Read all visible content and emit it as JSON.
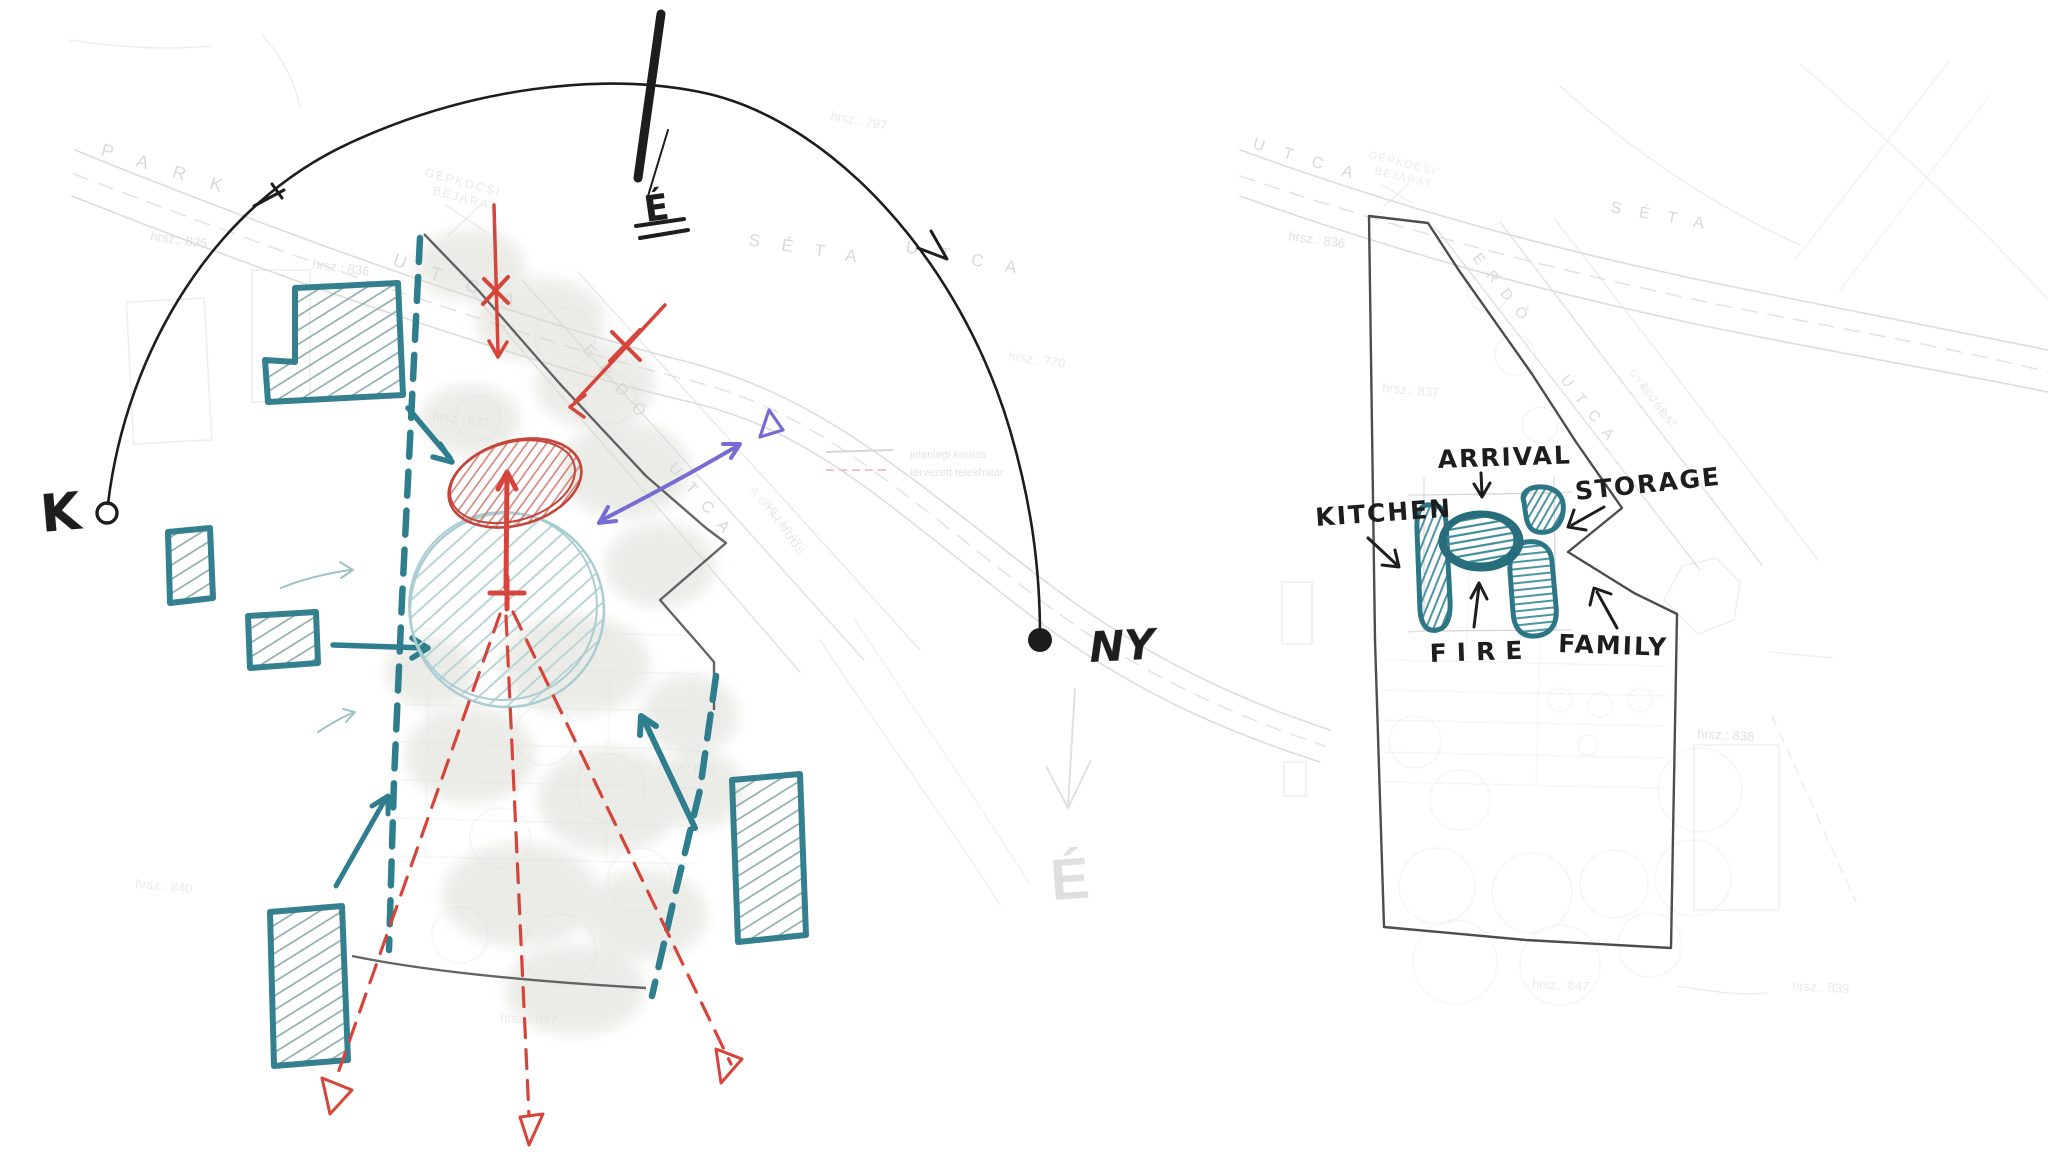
{
  "colors": {
    "ink": "#1d1d1d",
    "teal": "#2f7e8d",
    "teal_light": "#9dc3c7",
    "red": "#d6453c",
    "purple": "#776bd4",
    "map_gray": "#d7d7d5"
  },
  "left_sketch": {
    "compass": {
      "east": "K",
      "west": "NY",
      "north": "É",
      "map_north": "É"
    },
    "streets": {
      "park": "PARK",
      "park_utca": "UTCA",
      "seta": "SÉTA",
      "seta_utca": "UTCA",
      "erdo": "ERDŐ",
      "erdo_utca": "UTCA"
    },
    "entrances": {
      "gepkocsi_line1": "GÉPKOCSI",
      "gepkocsi_line2": "BEJÁRAT",
      "gyalogos_line1": "A GYALOGOS",
      "gyalogos_line2": "BEJÁRAT"
    },
    "parcels": {
      "p835": "hrsz.: 835",
      "p836": "hrsz.: 836",
      "p837": "hrsz.: 837",
      "p797": "hrsz.: 797",
      "p770": "hrsz.: 770",
      "p840": "hrsz.: 840",
      "p838": "hrsz.: 838",
      "p847": "hrsz.: 847"
    },
    "legend": {
      "item1": "jelenlegi kerítés",
      "item2": "tervezett telekhatár"
    }
  },
  "right_sketch": {
    "labels": {
      "arrival": "ARRIVAL",
      "storage": "STORAGE",
      "kitchen": "KITCHEN",
      "fire": "FIRE",
      "family": "FAMILY"
    },
    "streets": {
      "utca": "UTCA",
      "seta": "SÉTA",
      "erdo": "ERDŐ",
      "erdo_utca": "UTCA"
    },
    "entrances": {
      "gepkocsi_line1": "GÉPKOCSI",
      "gepkocsi_line2": "BEJÁRAT",
      "gyalogos_line1": "GYALOGOS",
      "gyalogos_line2": "BEJÁRAT"
    },
    "parcels": {
      "p836": "hrsz.: 836",
      "p837": "hrsz.: 837",
      "p838": "hrsz.: 838",
      "p847": "hrsz.: 847",
      "p839": "hrsz.: 839"
    }
  }
}
